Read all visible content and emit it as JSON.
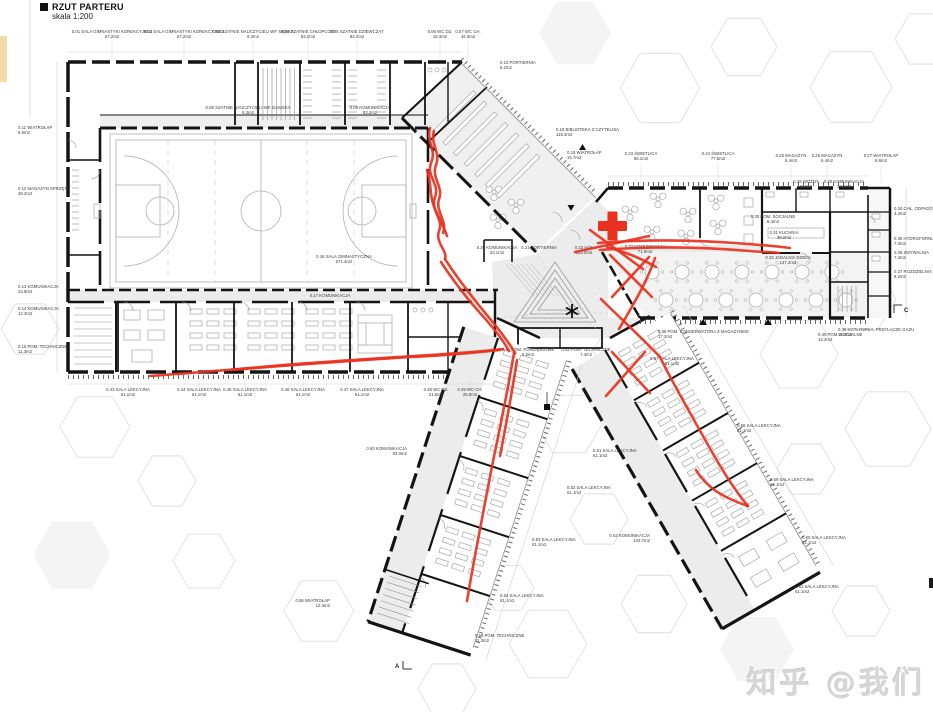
{
  "meta": {
    "title": "RZUT PARTERU",
    "scale": "skala 1:200"
  },
  "watermark": {
    "text": "知乎 @我们"
  },
  "colors": {
    "marker_red": "#e8321f",
    "wall": "#141414",
    "floor_gray": "#ececec",
    "thin_line": "#a8a8a8",
    "court_line": "#b0b0b0",
    "hex_line": "#e6e6e6",
    "hex_fill": "#f4f4f4",
    "label_text": "#3c3c3c",
    "leader": "#d2d2d2",
    "accent_tan": "#f2dcaa",
    "watermark_gray": "#d6d6d6"
  },
  "section_markers": {
    "a": "A",
    "c": "C"
  },
  "rooms": [
    {
      "t": "0.01 SALA GIMNASTYKI KOREKCYJNEJ",
      "a": "67.2m2",
      "x": 112,
      "y": 33,
      "an": "m",
      "ld": "d"
    },
    {
      "t": "0.02 SALA GIMNASTYKI KOREKCYJNEJ",
      "a": "67.2m2",
      "x": 184,
      "y": 33,
      "an": "m",
      "ld": "d"
    },
    {
      "t": "0.03 SZATNIE NAUCZYCIELI WF. MĘSKA",
      "a": "9.3m2",
      "x": 253,
      "y": 33,
      "an": "m",
      "ld": "d"
    },
    {
      "t": "0.04 SZATNIE CHŁOPCÓW",
      "a": "83.2m2",
      "x": 308,
      "y": 33,
      "an": "m",
      "ld": "d"
    },
    {
      "t": "0.05 SZATNIE DZIEWCZĄT",
      "a": "83.2m2",
      "x": 357,
      "y": 33,
      "an": "m",
      "ld": "d"
    },
    {
      "t": "0.06 WC DZ.",
      "a": "16.3m2",
      "x": 440,
      "y": 33,
      "an": "m",
      "ld": "d"
    },
    {
      "t": "0.07 WC CH.",
      "a": "16.3m2",
      "x": 468,
      "y": 33,
      "an": "m",
      "ld": "d"
    },
    {
      "t": "0.08 SZATNIE NAUCZYCIELI WF. DAMSKA",
      "a": "9.3m2",
      "x": 248,
      "y": 109,
      "an": "m",
      "ld": "n"
    },
    {
      "t": "0.09 KOMUNIKACJA",
      "a": "83.2m2",
      "x": 370,
      "y": 109,
      "an": "m",
      "ld": "n"
    },
    {
      "t": "0.10 PORTIERNIA",
      "a": "6.2m2",
      "x": 500,
      "y": 64,
      "an": "s",
      "ld": "n"
    },
    {
      "t": "0.11 WIATROŁAP",
      "a": "9.5m2",
      "x": 18,
      "y": 129,
      "an": "s",
      "ld": "n"
    },
    {
      "t": "0.12 MAGAZYN SPRZĘTU",
      "a": "48.2m2",
      "x": 18,
      "y": 190,
      "an": "s",
      "ld": "n"
    },
    {
      "t": "0.13 KOMUNIKACJA",
      "a": "23.8m2",
      "x": 18,
      "y": 288,
      "an": "s",
      "ld": "n"
    },
    {
      "t": "0.14 KOMUNIKACJA",
      "a": "12.3m2",
      "x": 18,
      "y": 310,
      "an": "s",
      "ld": "n"
    },
    {
      "t": "0.15 POM. TECHNICZNE",
      "a": "11.3m2",
      "x": 18,
      "y": 348,
      "an": "s",
      "ld": "n"
    },
    {
      "t": "0.16 SALA GIMNASTYCZNA",
      "a": "671.4m2",
      "x": 344,
      "y": 258,
      "an": "m",
      "ld": "n"
    },
    {
      "t": "0.17 KOMUNIKACJA",
      "a": "",
      "x": 330,
      "y": 297,
      "an": "m",
      "ld": "n"
    },
    {
      "t": "0.18 BIBLIOTEKA Z CZYTELNIĄ",
      "a": "118.4m2",
      "x": 556,
      "y": 131,
      "an": "s",
      "ld": "n"
    },
    {
      "t": "0.19 WIATROŁAP",
      "a": "15.7m2",
      "x": 567,
      "y": 154,
      "an": "s",
      "ld": "n"
    },
    {
      "t": "0.20 KOMUNIKACJA",
      "a": "23.1m2",
      "x": 497,
      "y": 249,
      "an": "m",
      "ld": "n"
    },
    {
      "t": "0.21 PORTIERNIA",
      "a": "",
      "x": 539,
      "y": 249,
      "an": "m",
      "ld": "n"
    },
    {
      "t": "0.22 HOL",
      "a": "223.0m2",
      "x": 584,
      "y": 249,
      "an": "m",
      "ld": "n"
    },
    {
      "t": "0.23 ŚWIETLICA",
      "a": "66.1m2",
      "x": 641,
      "y": 155,
      "an": "m",
      "ld": "d2"
    },
    {
      "t": "0.24 ŚWIETLICA",
      "a": "77.5m2",
      "x": 718,
      "y": 155,
      "an": "m",
      "ld": "d2"
    },
    {
      "t": "0.25 MAGAZYN",
      "a": "6.4m2",
      "x": 791,
      "y": 157,
      "an": "m",
      "ld": "d2"
    },
    {
      "t": "0.26 MAGAZYN",
      "a": "6.4m2",
      "x": 827,
      "y": 157,
      "an": "m",
      "ld": "d2"
    },
    {
      "t": "0.27 WIATROŁAP",
      "a": "8.8m2",
      "x": 881,
      "y": 157,
      "an": "m",
      "ld": "d2"
    },
    {
      "t": "0.28 WOŹNY",
      "a": "9.4m2",
      "x": 806,
      "y": 183,
      "an": "m",
      "ld": "n"
    },
    {
      "t": "0.29 KOMUNIKACJA",
      "a": "10.3m2",
      "x": 844,
      "y": 183,
      "an": "m",
      "ld": "n"
    },
    {
      "t": "0.30 POM. SOCJALNE",
      "a": "8.3m2",
      "x": 773,
      "y": 218,
      "an": "m",
      "ld": "n"
    },
    {
      "t": "0.31 KUCHNIA",
      "a": "39.2m2",
      "x": 784,
      "y": 234,
      "an": "m",
      "ld": "n"
    },
    {
      "t": "0.32 JADALNIA DZIECI",
      "a": "147.2m2",
      "x": 788,
      "y": 259,
      "an": "m",
      "ld": "n"
    },
    {
      "t": "0.33 KOMUNIKACJA",
      "a": "71.6m2",
      "x": 645,
      "y": 248,
      "an": "m",
      "ld": "n"
    },
    {
      "t": "0.34 CHŁ. ODPADÓW",
      "a": "4.3m2",
      "x": 894,
      "y": 210,
      "an": "s",
      "ld": "n"
    },
    {
      "t": "0.35 HYDROFORNIA",
      "a": "7.3m2",
      "x": 894,
      "y": 240,
      "an": "s",
      "ld": "n"
    },
    {
      "t": "0.36 ZMYWALNIA",
      "a": "7.3m2",
      "x": 894,
      "y": 254,
      "an": "s",
      "ld": "n"
    },
    {
      "t": "0.37 ROZDZIELNIA POSIŁKÓW",
      "a": "8.2m2",
      "x": 894,
      "y": 273,
      "an": "s",
      "ld": "n"
    },
    {
      "t": "0.38 KOTŁOWNIA, PRZYŁĄCZE GAZU",
      "a": "31.2m2",
      "x": 838,
      "y": 331,
      "an": "s",
      "ld": "n"
    },
    {
      "t": "0.39 POM. KONSERWATORA Z MAGAZYNEM",
      "a": "17.2m2",
      "x": 658,
      "y": 333,
      "an": "s",
      "ld": "n"
    },
    {
      "t": "0.40 POM. SOCJALNE",
      "a": "12.2m2",
      "x": 818,
      "y": 336,
      "an": "s",
      "ld": "n"
    },
    {
      "t": "0.41 POM. PORZĄDKOWE",
      "a": "5.6m2",
      "x": 528,
      "y": 351,
      "an": "m",
      "ld": "n"
    },
    {
      "t": "0.42 POM. TECHNICZNE",
      "a": "7.3m2",
      "x": 586,
      "y": 351,
      "an": "m",
      "ld": "n"
    },
    {
      "t": "0.43 SALA LEKCYJNA",
      "a": "61.1m2",
      "x": 128,
      "y": 391,
      "an": "m",
      "ld": "u"
    },
    {
      "t": "0.44 SALA LEKCYJNA",
      "a": "61.1m2",
      "x": 199,
      "y": 391,
      "an": "m",
      "ld": "u"
    },
    {
      "t": "0.45 SALA LEKCYJNA",
      "a": "61.1m2",
      "x": 245,
      "y": 391,
      "an": "m",
      "ld": "u"
    },
    {
      "t": "0.46 SALA LEKCYJNA",
      "a": "61.1m2",
      "x": 303,
      "y": 391,
      "an": "m",
      "ld": "u"
    },
    {
      "t": "0.47 SALA LEKCYJNA",
      "a": "61.1m2",
      "x": 362,
      "y": 391,
      "an": "m",
      "ld": "u"
    },
    {
      "t": "0.48 WC DZ.",
      "a": "21.5m2",
      "x": 436,
      "y": 391,
      "an": "m",
      "ld": "u"
    },
    {
      "t": "0.49 WC CH.",
      "a": "25.8m2",
      "x": 470,
      "y": 391,
      "an": "m",
      "ld": "u"
    },
    {
      "t": "0.50 KOMUNIKACJA",
      "a": "93.0m2",
      "x": 407,
      "y": 450,
      "an": "e",
      "ld": "n"
    },
    {
      "t": "0.51 SALA LEKCYJNA",
      "a": "61.1m2",
      "x": 593,
      "y": 452,
      "an": "s",
      "ld": "n"
    },
    {
      "t": "0.52 SALA LEKCYJNA",
      "a": "61.1m2",
      "x": 567,
      "y": 489,
      "an": "s",
      "ld": "n"
    },
    {
      "t": "0.53 SALA LEKCYJNA",
      "a": "61.1m2",
      "x": 532,
      "y": 541,
      "an": "s",
      "ld": "n"
    },
    {
      "t": "0.54 SALA LEKCYJNA",
      "a": "61.1m2",
      "x": 500,
      "y": 597,
      "an": "s",
      "ld": "n"
    },
    {
      "t": "0.55 POM. TECHNICZNE",
      "a": "11.3m2",
      "x": 475,
      "y": 637,
      "an": "s",
      "ld": "n"
    },
    {
      "t": "0.56 WIATROŁAP",
      "a": "12.3m2",
      "x": 330,
      "y": 602,
      "an": "e",
      "ld": "n"
    },
    {
      "t": "0.57 SALA LEKCYJNA",
      "a": "61.1m2",
      "x": 672,
      "y": 360,
      "an": "m",
      "ld": "n"
    },
    {
      "t": "0.58 SALA LEKCYJNA",
      "a": "61.1m2",
      "x": 737,
      "y": 427,
      "an": "s",
      "ld": "n"
    },
    {
      "t": "0.59 SALA LEKCYJNA",
      "a": "61.1m2",
      "x": 770,
      "y": 481,
      "an": "s",
      "ld": "n"
    },
    {
      "t": "0.60 SALA LEKCYJNA",
      "a": "61.1m2",
      "x": 802,
      "y": 539,
      "an": "s",
      "ld": "n"
    },
    {
      "t": "0.61 SALA LEKCYJNA",
      "a": "61.1m2",
      "x": 795,
      "y": 588,
      "an": "s",
      "ld": "n"
    },
    {
      "t": "0.62 KOMUNIKACJA",
      "a": "103.7m2",
      "x": 650,
      "y": 537,
      "an": "e",
      "ld": "n"
    }
  ]
}
